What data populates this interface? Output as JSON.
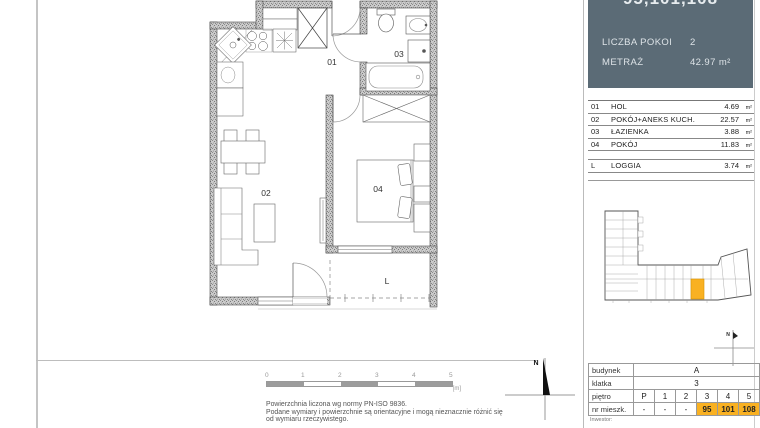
{
  "header": {
    "title": "95,101,108",
    "rows": [
      {
        "label": "LICZBA POKOI",
        "value": "2"
      },
      {
        "label": "METRAŻ",
        "value": "42.97 m²"
      }
    ]
  },
  "room_table": {
    "rows": [
      {
        "no": "01",
        "name": "HOL",
        "area": "4.69",
        "unit": "m²"
      },
      {
        "no": "02",
        "name": "POKÓJ+ANEKS KUCH.",
        "area": "22.57",
        "unit": "m²"
      },
      {
        "no": "03",
        "name": "ŁAZIENKA",
        "area": "3.88",
        "unit": "m²"
      },
      {
        "no": "04",
        "name": "POKÓJ",
        "area": "11.83",
        "unit": "m²"
      }
    ],
    "loggia_row": {
      "no": "L",
      "name": "LOGGIA",
      "area": "3.74",
      "unit": "m²"
    }
  },
  "plan_labels": {
    "hall": "01",
    "living": "02",
    "bath": "03",
    "bedroom": "04",
    "loggia": "L"
  },
  "scale_bar": {
    "ticks": [
      "0",
      "1",
      "2",
      "3",
      "4",
      "5"
    ],
    "unit": "[m]"
  },
  "disclaimer": [
    "Powierzchnia liczona wg normy PN-ISO 9836.",
    "Podane wymiary i powierzchnie  są orientacyjne i mogą nieznacznie różnić się",
    "od wymiaru rzeczywistego."
  ],
  "north_label": "N",
  "info_table": {
    "budynek_label": "budynek",
    "budynek_value": "A",
    "klatka_label": "klatka",
    "klatka_value": "3",
    "pietro_label": "piętro",
    "pietro_cells": [
      "P",
      "1",
      "2",
      "3",
      "4",
      "5"
    ],
    "mieszk_label": "nr mieszk.",
    "mieszk_cells": [
      "-",
      "-",
      "-",
      "95",
      "101",
      "108"
    ],
    "inwestor_label": "Inwestor:"
  },
  "colors": {
    "header_bg": "#5b6b76",
    "highlight": "#f9b122"
  }
}
